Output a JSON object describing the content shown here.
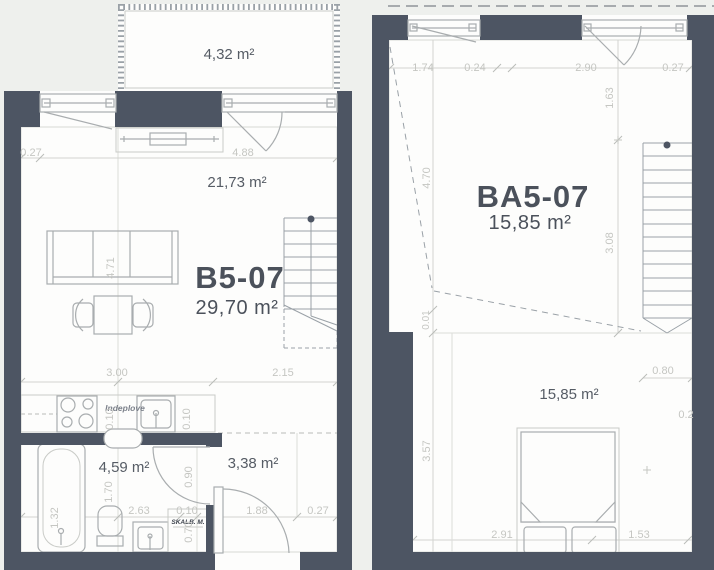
{
  "palette": {
    "wall": "#4d5563",
    "floor": "#fdfdfc",
    "background": "#eef0ed",
    "dim_text": "#c5c6c2",
    "label_text": "#4b515b"
  },
  "left_unit": {
    "balcony_area": "4,32 m²",
    "living_area": "21,73 m²",
    "unit_id": "B5-07",
    "unit_area": "29,70 m²",
    "bath_area": "4,59 m²",
    "entry_area": "3,38 m²",
    "kitchen_label": "Indeplove",
    "washer_label": "SKALB. M.",
    "dims": {
      "wall_offset_top": "0.27",
      "facade_width": "4.88",
      "room_depth": "4.71",
      "room_width": "3.00",
      "hall_width": "2.15",
      "counter_depth_a": "0.10",
      "counter_depth_b": "0.10",
      "tub_width": "1.32",
      "tub_length": "1.70",
      "bath_width": "2.63",
      "wall_thickness": "0.10",
      "door_width": "0.90",
      "washer_width": "0.70",
      "entry_width": "1.88",
      "wall_offset_bottom": "0.27"
    }
  },
  "right_unit": {
    "unit_id": "BA5-07",
    "unit_area": "15,85 m²",
    "room_area": "15,85 m²",
    "dims": {
      "seg_a": "1.74",
      "seg_b": "0.24",
      "seg_c": "2.90",
      "seg_d": "0.27",
      "drop_height": "1.63",
      "ceiling_a": "4.70",
      "ceiling_b": "3.08",
      "gap": "0.01",
      "stair_width": "0.80",
      "ceiling_c": "3.57",
      "bed_span": "2.91",
      "side_span": "1.53",
      "edge_offset": "0.2"
    }
  }
}
